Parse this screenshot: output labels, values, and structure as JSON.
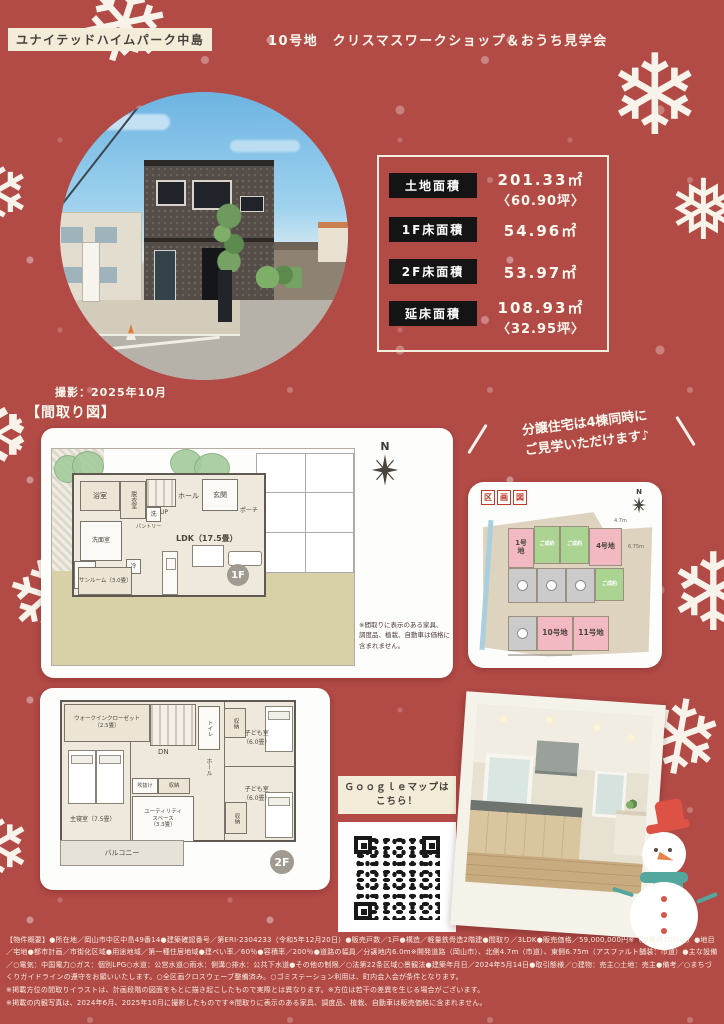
{
  "colors": {
    "bg_red": "#b24a46",
    "cream": "#f2ecd9",
    "chip_black": "#141414",
    "lot_pink": "#f2b9c3",
    "lot_green": "#abd492",
    "lot_gray": "#cbcbcb"
  },
  "header": {
    "brand": "ユナイテッドハイムパーク中島",
    "title": "10号地　クリスマスワークショップ＆おうち見学会"
  },
  "area_table": {
    "rows": [
      {
        "label": "土地面積",
        "value": "201.33㎡",
        "sub": "〈60.90坪〉"
      },
      {
        "label": "1F床面積",
        "value": "54.96㎡",
        "sub": ""
      },
      {
        "label": "2F床面積",
        "value": "53.97㎡",
        "sub": ""
      },
      {
        "label": "延床面積",
        "value": "108.93㎡",
        "sub": "〈32.95坪〉"
      }
    ]
  },
  "photo_note": "撮影：2025年10月",
  "madori_heading": "【間取り図】",
  "banner": {
    "line1": "分譲住宅は4棟同時に",
    "line2": "ご見学いただけます♪"
  },
  "plan1f": {
    "badge": "1F",
    "compass": "N",
    "rooms": {
      "bath": "浴室",
      "dressing": "脱衣室",
      "wash": "洗",
      "stairs_up": "UP",
      "pantry": "パントリー",
      "hall": "ホール",
      "entrance": "玄関",
      "porch": "ポーチ",
      "ldk": "LDK（17.5畳）",
      "lavatory": "洗面室",
      "fridge": "冷",
      "sunroom": "サンルーム（3.0畳）"
    },
    "note": [
      "※間取りに表示のある家具、",
      "調度品、植栽、自動車は価格に",
      "含まれません。"
    ]
  },
  "lot_map": {
    "t1": "区",
    "t2": "画",
    "t3": "図",
    "compass": "N",
    "lot1": "1号地",
    "sold1": "ご成約",
    "sold2": "ご成約",
    "lot4": "4号地",
    "sold3": "ご成約",
    "lot10": "10号地",
    "lot11": "11号地",
    "dim_top": "4.7m",
    "dim_right": "6.75m"
  },
  "plan2f": {
    "badge": "2F",
    "rooms": {
      "wic1": "ウォークインクローゼット",
      "wic2": "（2.5畳）",
      "dn": "DN",
      "toilet": "トイレ",
      "closet_top": "収納",
      "kids1a": "子ども室",
      "kids1b": "（6.0畳）",
      "kids2a": "子ども室",
      "kids2b": "（6.0畳）",
      "hall": "ホール",
      "void": "吹抜け",
      "closet_mid": "収納",
      "util1": "ユーティリティ",
      "util2": "スペース",
      "util3": "（3.3畳）",
      "closet_bottom": "収納",
      "bedroom": "主寝室（7.5畳）",
      "balcony": "バルコニー"
    }
  },
  "gmap": {
    "line1": "Ｇｏｏｇｌｅマップは",
    "line2": "こちら！"
  },
  "footer": {
    "para1": "【物件概要】●所在地／岡山市中区中島49番14●建築確認番号／第ERI-2304233（令和5年12月20日）●販売戸数／1戸●構造／軽量鉄骨造2階建●間取り／3LDK●販売価格／59,000,000円※（消費税10％込）●地目／宅地●都市計画／市街化区域●用途地域／第一種住居地域●建ぺい率／60％●容積率／200％●道路の幅員／分譲地内6.0m※開発道路（岡山市）、北側4.7m（市道）、東側6.75m（アスファルト舗装：市道）●主な設備／○電気：中国電力○ガス：個別LPG○水道：公営水道○雨水：側溝○排水：公共下水道●その他の制限／○法第22条区域○景観法●建築年月日／2024年5月14日●取引態様／○建物：売主○土地：売主●備考／○まちづくりガイドラインの遵守をお願いいたします。○全区画クロスウェーブ整備済み。○ゴミステーション利用は、町内会入会が条件となります。",
    "para2": "※掲載方位の間取りイラストは、計画段階の図面をもとに描き起こしたもので実際とは異なります。※方位は若干の差異を生じる場合がございます。",
    "para3": "※掲載の内観写真は、2024年6月、2025年10月に撮影したものです※間取りに表示のある家具、調度品、植栽、自動車は販売価格に含まれません。"
  }
}
